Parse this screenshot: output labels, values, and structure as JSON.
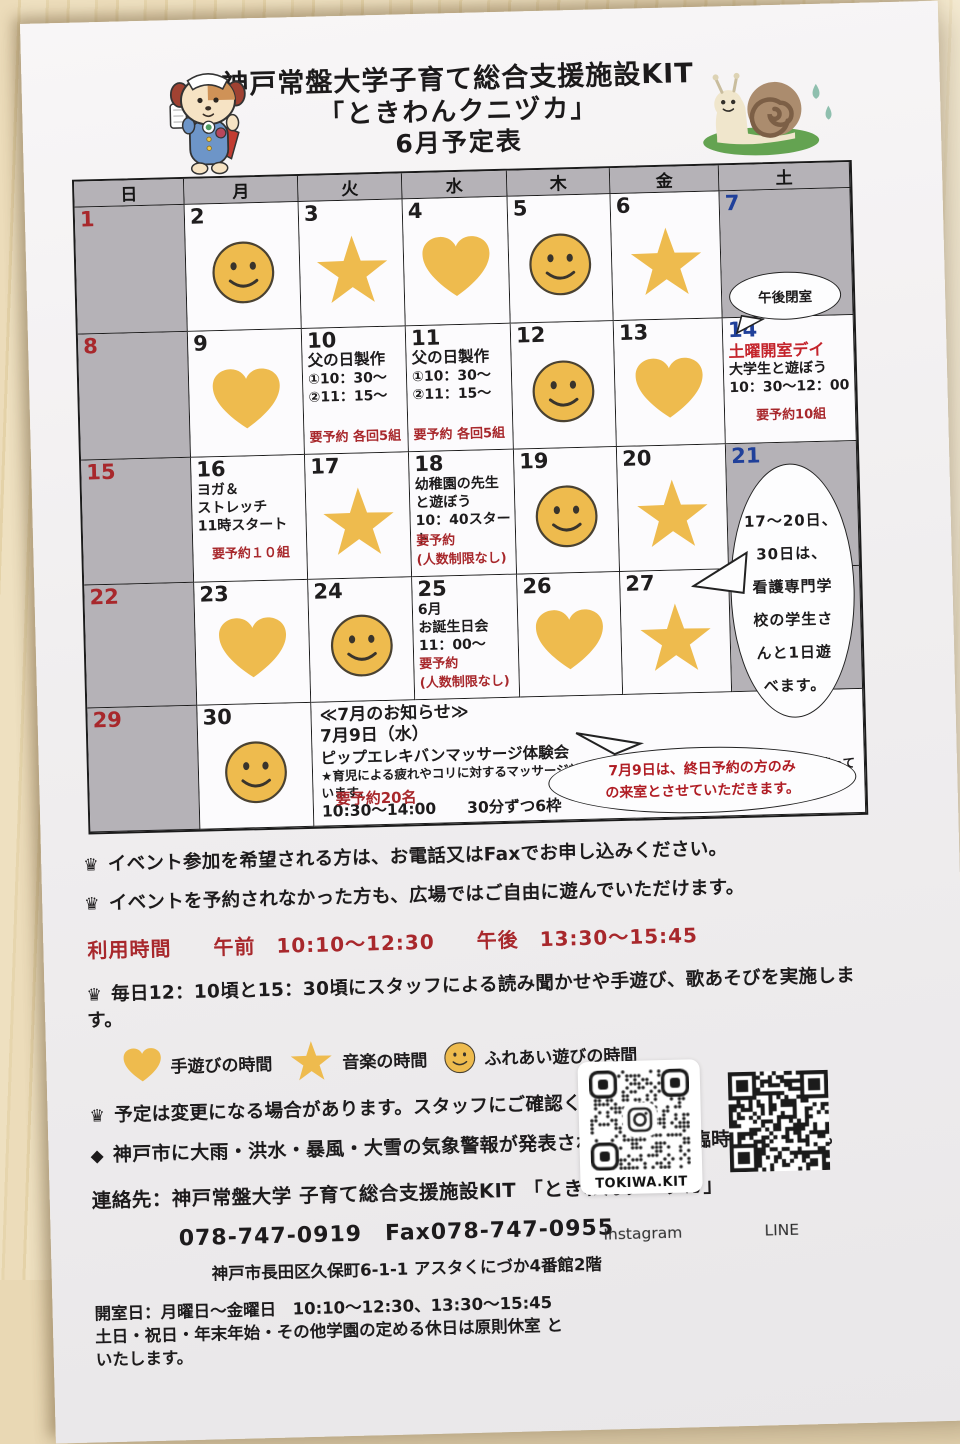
{
  "title": {
    "line1": "神戸常盤大学子育て総合支援施設KIT",
    "line2": "「ときわんクニヅカ」",
    "line3": "6月予定表"
  },
  "colors": {
    "gold": "#eebb4e",
    "gray_cell": "#b5b2b7",
    "date_red": "#a8282c",
    "date_blue": "#20409a",
    "accent_red": "#c4232b",
    "note_red": "#a8282c"
  },
  "calendar": {
    "weekdays": [
      "日",
      "月",
      "火",
      "水",
      "木",
      "金",
      "土"
    ],
    "rows": [
      [
        {
          "day": "1",
          "dc": "sun",
          "bg": "g"
        },
        {
          "day": "2",
          "icon": "smiley"
        },
        {
          "day": "3",
          "icon": "star"
        },
        {
          "day": "4",
          "icon": "heart"
        },
        {
          "day": "5",
          "icon": "smiley"
        },
        {
          "day": "6",
          "icon": "star"
        },
        {
          "day": "7",
          "dc": "sat",
          "bg": "g"
        }
      ],
      [
        {
          "day": "8",
          "dc": "sun",
          "bg": "g"
        },
        {
          "day": "9",
          "icon": "heart"
        },
        {
          "day": "10",
          "ev": {
            "title": "父の日製作",
            "lines": [
              "①10：30～",
              "②11：15～"
            ],
            "note": "要予約 各回5組"
          }
        },
        {
          "day": "11",
          "ev": {
            "title": "父の日製作",
            "lines": [
              "①10：30～",
              "②11：15～"
            ],
            "note": "要予約 各回5組"
          }
        },
        {
          "day": "12",
          "icon": "smiley"
        },
        {
          "day": "13",
          "icon": "heart"
        },
        {
          "day": "14",
          "dc": "sat",
          "ev": {
            "title_red": "土曜開室デイ",
            "lines": [
              "大学生と遊ぼう",
              "10：30～12：00"
            ],
            "note": "要予約10組",
            "center": true
          }
        }
      ],
      [
        {
          "day": "15",
          "dc": "sun",
          "bg": "g"
        },
        {
          "day": "16",
          "ev": {
            "lines": [
              "ヨガ＆",
              "ストレッチ",
              "11時スタート"
            ],
            "note": "要予約１０組",
            "center": true
          }
        },
        {
          "day": "17",
          "icon": "star"
        },
        {
          "day": "18",
          "ev": {
            "lines": [
              "幼稚園の先生",
              "と遊ぼう",
              "10：40スタート"
            ],
            "note": "要予約",
            "note2": "(人数制限なし)"
          }
        },
        {
          "day": "19",
          "icon": "smiley"
        },
        {
          "day": "20",
          "icon": "star"
        },
        {
          "day": "21",
          "dc": "sat",
          "bg": "g"
        }
      ],
      [
        {
          "day": "22",
          "dc": "sun",
          "bg": "g"
        },
        {
          "day": "23",
          "icon": "heart"
        },
        {
          "day": "24",
          "icon": "smiley"
        },
        {
          "day": "25",
          "ev": {
            "lines": [
              "6月",
              "お誕生日会",
              "11：00～"
            ],
            "note": "要予約",
            "note2": "(人数制限なし)"
          }
        },
        {
          "day": "26",
          "icon": "heart"
        },
        {
          "day": "27",
          "icon": "star"
        },
        {
          "bg": "g"
        }
      ],
      [
        {
          "day": "29",
          "dc": "sun",
          "bg": "g"
        },
        {
          "day": "30",
          "icon": "smiley"
        },
        {
          "july": true
        }
      ]
    ],
    "bubbles": {
      "pm_closed": "午後閉室",
      "students_lines": [
        "17～20日、",
        "30日は、",
        "看護専門学",
        "校の学生さ",
        "んと1日遊",
        "べます。"
      ],
      "july_lines": [
        "7月9日は、終日予約の方のみ",
        "の来室とさせていただきます。"
      ]
    },
    "july": {
      "heading": "≪7月のお知らせ≫",
      "date": "7月9日（水）",
      "event": "ピップエレキバンマッサージ体験会",
      "detail": "★育児による疲れやコリに対するマッサージ効果を調査する研究にご協力いただける方を募っています。",
      "time": "10:30～14:00　　30分ずつ6枠",
      "note": "要予約20名"
    }
  },
  "footer": {
    "note1": "イベント参加を希望される方は、お電話又はFaxでお申し込みください。",
    "note2": "イベントを予約されなかった方も、広場ではご自由に遊んでいただけます。",
    "hours": "利用時間　　午前　10:10～12:30　　午後　13:30～15:45",
    "daily": "毎日12：10頃と15：30頃にスタッフによる読み聞かせや手遊び、歌あそびを実施します。",
    "legend": [
      {
        "icon": "heart",
        "label": "手遊びの時間"
      },
      {
        "icon": "star",
        "label": "音楽の時間"
      },
      {
        "icon": "smiley",
        "label": "ふれあい遊びの時間"
      }
    ],
    "caution": "予定は変更になる場合があります。スタッフにご確認ください。",
    "weather": "神戸市に大雨・洪水・暴風・大雪の気象警報が発表された場合は、臨時休室します。"
  },
  "contact": {
    "line1": "連絡先：神戸常盤大学 子育て総合支援施設KIT 「ときわんクニヅカ」",
    "line2": "078-747-0919　Fax078-747-0955",
    "line3": "神戸市長田区久保町6-1-1 アスタくにづか4番館2階"
  },
  "opening": {
    "line1": "開室日：月曜日～金曜日　10:10～12:30、13:30～15:45",
    "line2": "土日・祝日・年末年始・その他学園の定める休日は原則休室 と",
    "line3": "いたします。"
  },
  "qr": {
    "instagram_caption": "TOKIWA.KIT",
    "instagram_label": "Instagram",
    "line_label": "LINE"
  }
}
